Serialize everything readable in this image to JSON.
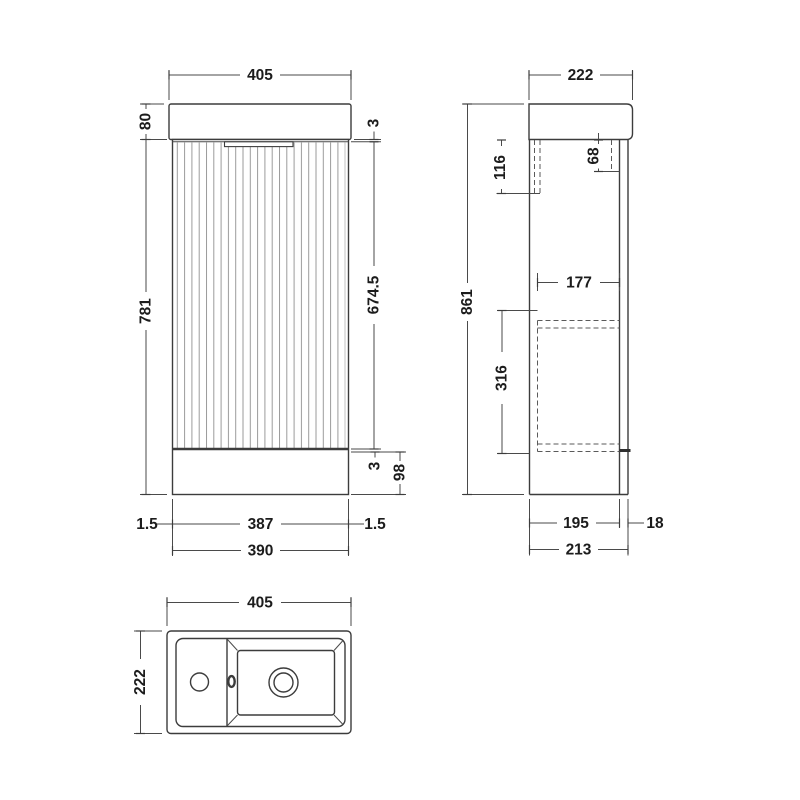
{
  "drawing": {
    "background": "#ffffff",
    "line_color": "#3c3c3c",
    "dim_color": "#4a4a4a",
    "text_color": "#1c1c1c",
    "flute_color": "#9b9b9b"
  },
  "views": {
    "front": {
      "label": "front-elevation",
      "dims": {
        "top_width": "405",
        "basin_height": "80",
        "cabinet_height": "781",
        "door_top_gap": "3",
        "door_height": "674.5",
        "door_bottom_gap": "3",
        "plinth_height": "98",
        "left_gap": "1.5",
        "door_width": "387",
        "right_gap": "1.5",
        "base_width": "390"
      }
    },
    "side": {
      "label": "side-elevation",
      "dims": {
        "top_depth": "222",
        "basin_depth_back": "116",
        "basin_depth_front": "68",
        "internal_depth": "177",
        "total_height": "861",
        "internal_height": "316",
        "carcass_depth": "195",
        "door_thickness": "18",
        "cabinet_depth": "213"
      }
    },
    "plan": {
      "label": "plan-view",
      "dims": {
        "width": "405",
        "depth": "222"
      }
    }
  }
}
